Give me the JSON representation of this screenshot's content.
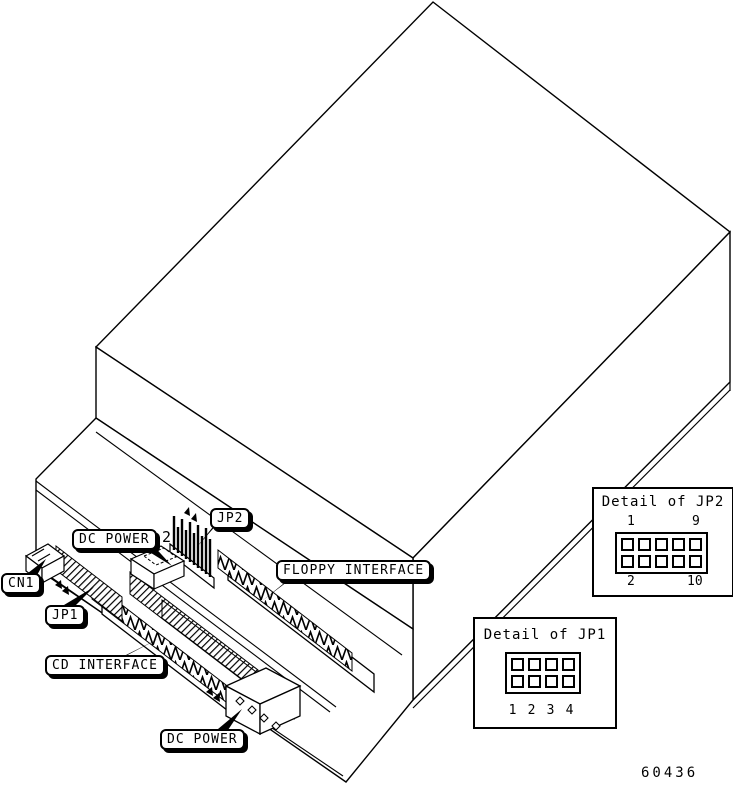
{
  "figure": {
    "number": "60436",
    "background": "#ffffff",
    "line_color": "#000000"
  },
  "callouts": [
    {
      "id": "jp2",
      "label": "JP2"
    },
    {
      "id": "dc-power-top",
      "label": "DC POWER"
    },
    {
      "id": "cn1",
      "label": "CN1"
    },
    {
      "id": "jp1",
      "label": "JP1"
    },
    {
      "id": "floppy-interface",
      "label": "FLOPPY INTERFACE"
    },
    {
      "id": "cd-interface",
      "label": "CD INTERFACE"
    },
    {
      "id": "dc-power-bottom",
      "label": "DC POWER"
    }
  ],
  "annotations": {
    "jp2_pin2_marker": "2"
  },
  "details": {
    "jp2": {
      "title": "Detail of JP2",
      "rows": 2,
      "cols": 5,
      "corner_labels": {
        "top_left": "1",
        "top_right": "9",
        "bottom_left": "2",
        "bottom_right": "10"
      }
    },
    "jp1": {
      "title": "Detail of JP1",
      "rows": 2,
      "cols": 4,
      "pin_labels": [
        "1",
        "2",
        "3",
        "4"
      ]
    }
  }
}
